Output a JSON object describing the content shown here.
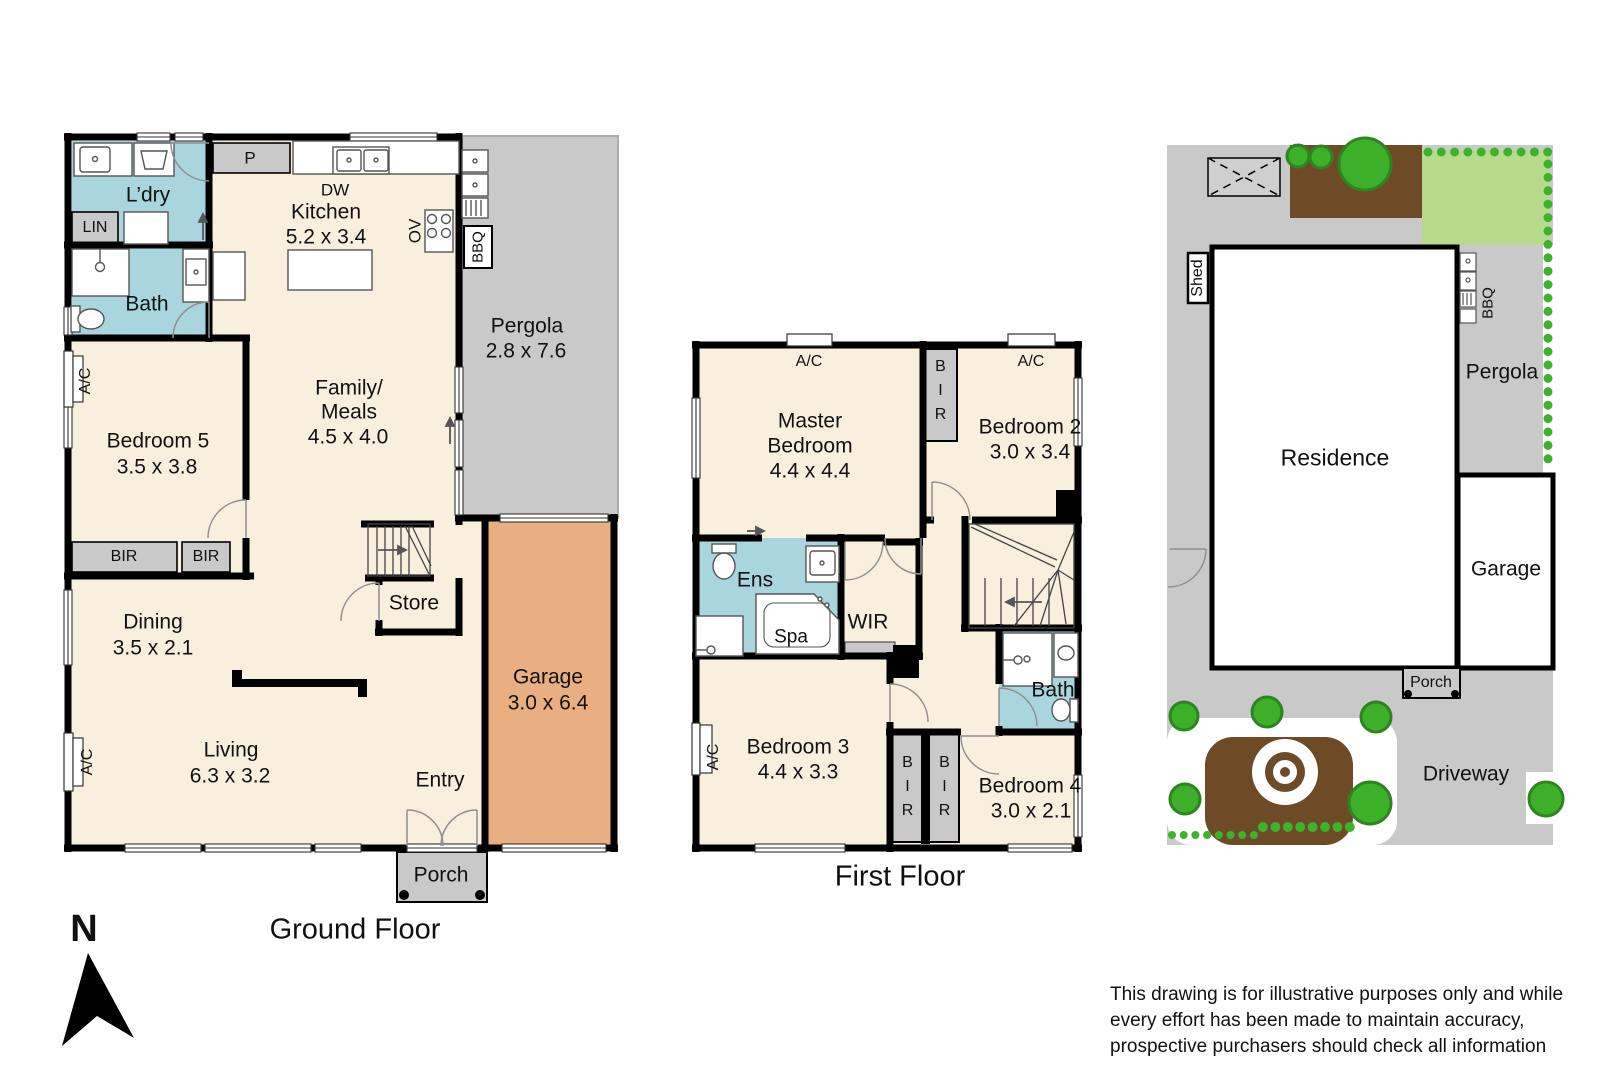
{
  "colors": {
    "wall": "#000000",
    "room_fill": "#F8F0DD",
    "wet_fill": "#A9D6DE",
    "gray_fill": "#C9C9C9",
    "garage_fill": "#E9AF80",
    "lawn": "#B7DB8A",
    "soil": "#6F4A26",
    "tree": "#3CB028",
    "hedge_dot": "#3CB32B"
  },
  "gf": {
    "title": "Ground Floor",
    "ldry": "L’dry",
    "lin": "LIN",
    "bath": "Bath",
    "bed5": "Bedroom 5",
    "bed5_dims": "3.5 x 3.8",
    "bir1": "BIR",
    "bir2": "BIR",
    "pantry": "P",
    "dw": "DW",
    "kitchen": "Kitchen",
    "kitchen_dims": "5.2 x 3.4",
    "ov": "OV",
    "bbq": "BBQ",
    "family1": "Family/",
    "family2": "Meals",
    "family_dims": "4.5 x 4.0",
    "pergola": "Pergola",
    "pergola_dims": "2.8 x 7.6",
    "store": "Store",
    "garage": "Garage",
    "garage_dims": "3.0 x 6.4",
    "dining": "Dining",
    "dining_dims": "3.5 x 2.1",
    "living": "Living",
    "living_dims": "6.3 x 3.2",
    "entry": "Entry",
    "porch": "Porch",
    "ac1": "A/C",
    "ac2": "A/C"
  },
  "ff": {
    "title": "First Floor",
    "master1": "Master",
    "master2": "Bedroom",
    "master_dims": "4.4 x 4.4",
    "bed2": "Bedroom 2",
    "bed2_dims": "3.0 x 3.4",
    "bed3": "Bedroom 3",
    "bed3_dims": "4.4 x 3.3",
    "bed4": "Bedroom 4",
    "bed4_dims": "3.0 x 2.1",
    "ens": "Ens",
    "spa": "Spa",
    "wir": "WIR",
    "bath": "Bath",
    "bir1": "BIR",
    "bir2": "BIR",
    "bir3": "BIR",
    "ac1": "A/C",
    "ac2": "A/C",
    "ac3": "A/C"
  },
  "site": {
    "shed": "Shed",
    "bbq": "BBQ",
    "pergola": "Pergola",
    "residence": "Residence",
    "garage": "Garage",
    "porch": "Porch",
    "driveway": "Driveway"
  },
  "misc": {
    "north": "N",
    "disclaimer1": "This drawing is for illustrative purposes only and while",
    "disclaimer2": "every effort has been made to maintain accuracy,",
    "disclaimer3": "prospective purchasers should check all information"
  }
}
